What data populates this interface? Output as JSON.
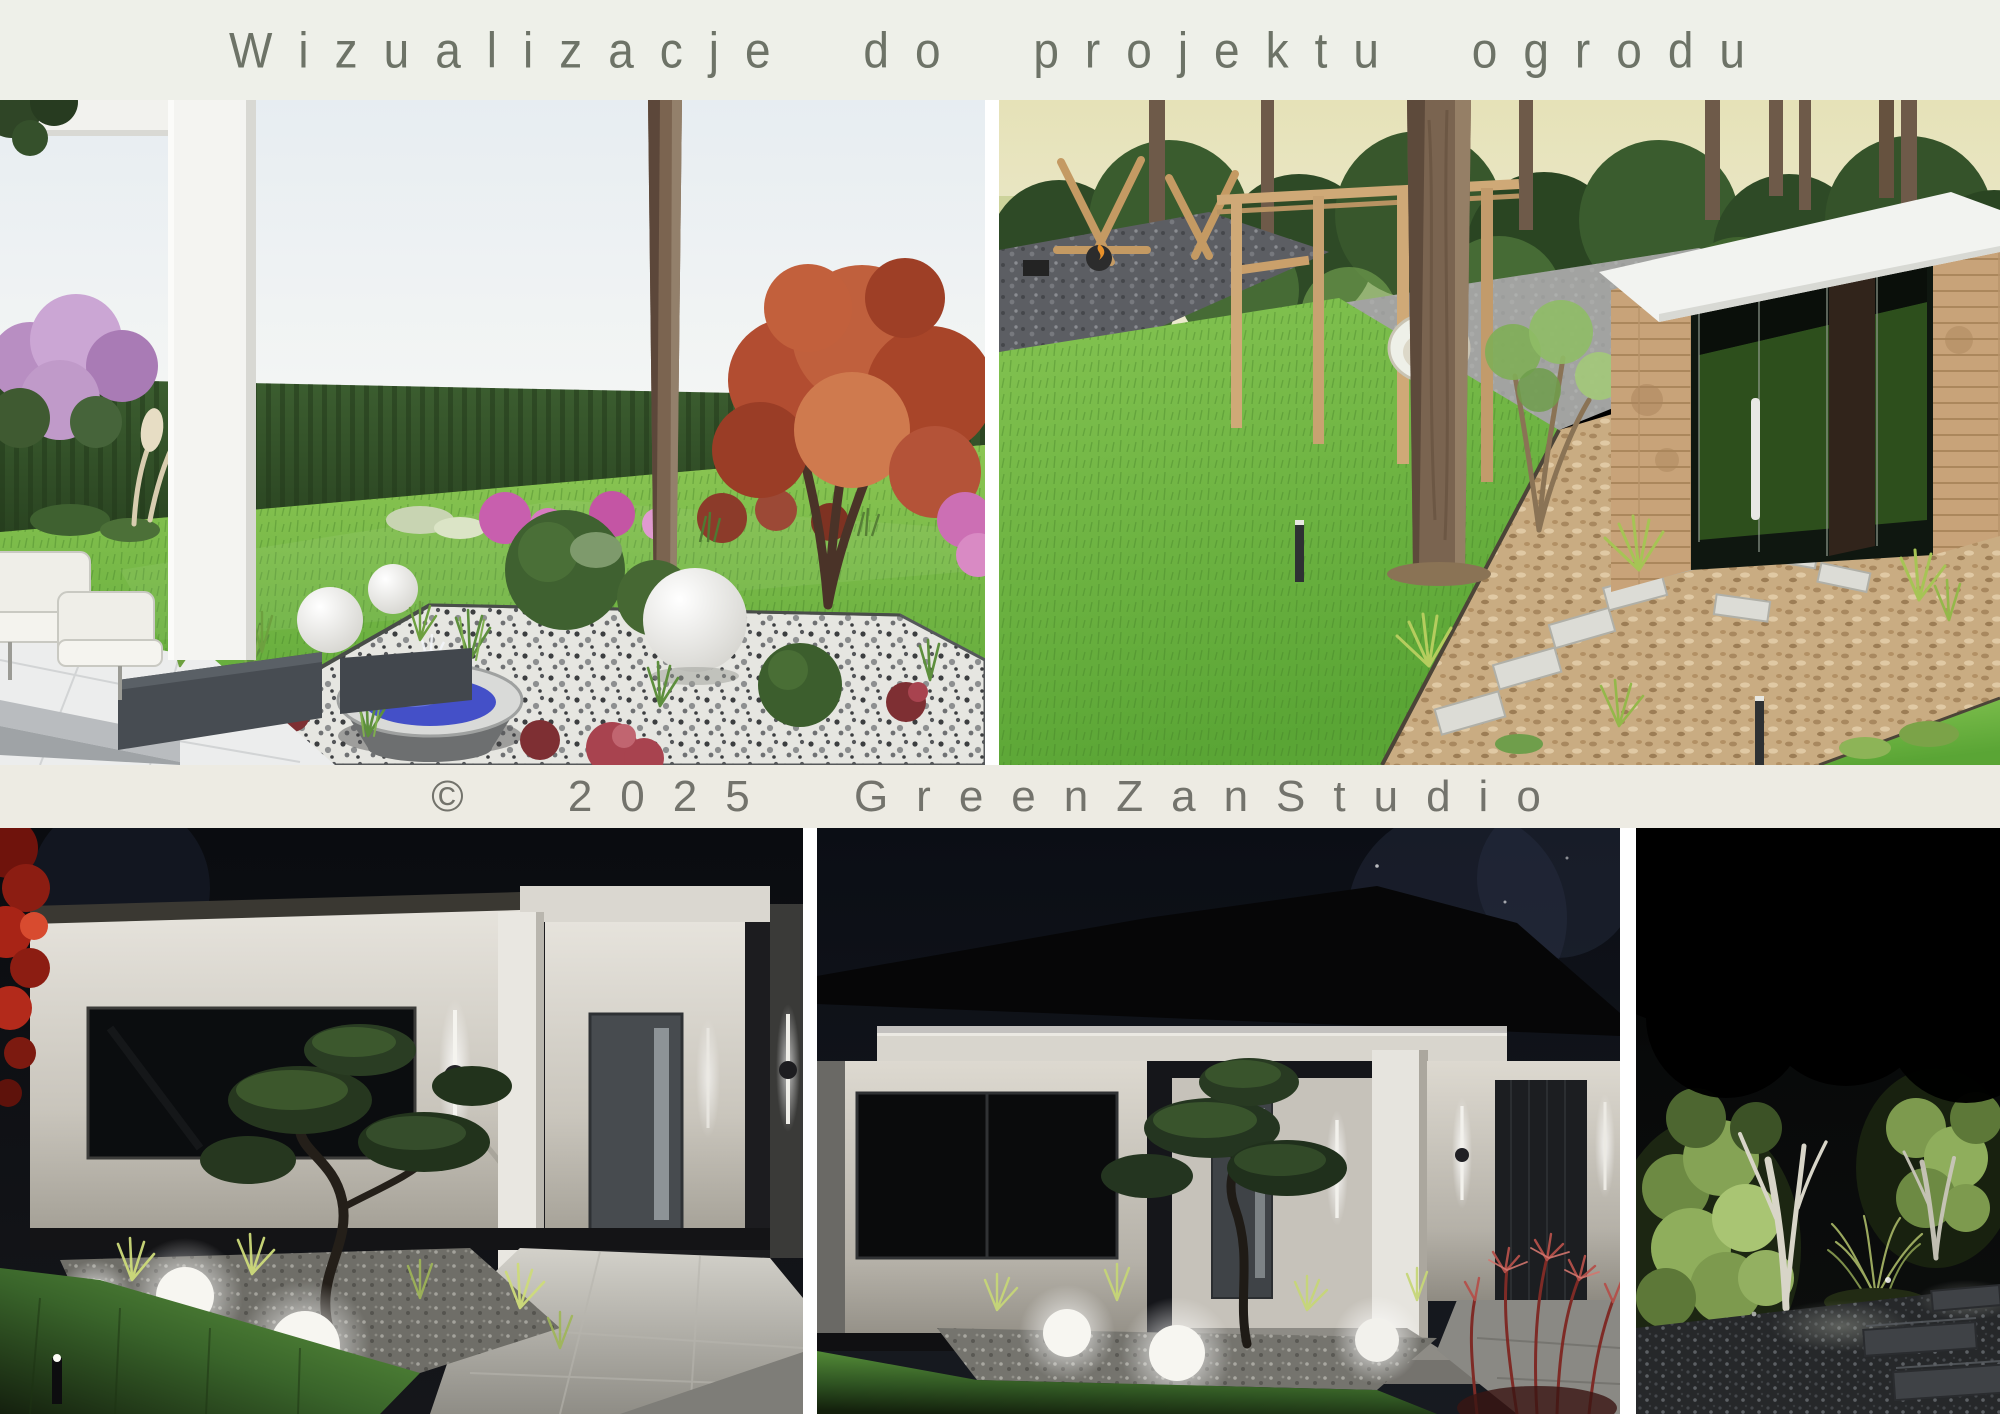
{
  "poster": {
    "width_px": 2000,
    "height_px": 1414,
    "background": "#ffffff",
    "gap_color": "#ffffff"
  },
  "header": {
    "title": "Wizualizacje do projektu ogrodu",
    "background": "#eef0e9",
    "text_color": "#6d7367"
  },
  "copyright_bar": {
    "text": "© 2025 GreenZanStudio",
    "background": "#edebe3",
    "text_color": "#73736c"
  },
  "panels": [
    {
      "id": "top-left",
      "description": "Daytime garden render: white patio columns and terrace, grey planter boxes, white marble pebble island bed with steel bowl fountain with blue water, white sphere lamps, boxwood balls, ornamental grasses, red heuchera, red Japanese maple, pink azaleas and lilac, tall thuja hedge with wire fence and pale field beyond",
      "palette": {
        "sky": "#e9eff3",
        "lawn": "#69b23f",
        "hedge": "#33512a",
        "maple": "#b24d31",
        "fountain_water": "#4450c8"
      }
    },
    {
      "id": "top-right",
      "description": "Daytime garden render: diagonal lawn, bark mulch bed with light stepping stones, tall pine trunk, wooden pergola with hanging egg chair, dark gravel fire-pit corner with timber frame, timber cube garden room with dark glass front, white handle and white roof",
      "palette": {
        "sky": "#e3dfb2",
        "lawn": "#6ab33e",
        "bark": "#c9ac82",
        "cube_wood": "#c8a379"
      }
    },
    {
      "id": "bottom-left",
      "description": "Night render: house entrance with illuminated white facade, dark window, vertical LED wall lights with disc, recessed grey door, cloud-pruned niwaki pine, glowing sphere lamps on gravel, uplit lawn, light tiled walkway, red creeper on left edge",
      "palette": {
        "night": "#0a0c10",
        "wall": "#ddd9d1",
        "grass": "#4f8a36",
        "creeper": "#b32a1b"
      }
    },
    {
      "id": "bottom-middle",
      "description": "Night render: wide view of single-storey house with dark hip roof, lit white walls, dark windows, porch column, vertical LED sconces, dark garage door, niwaki tree with three glowing sphere lamps, lawn and red fountain grasses in foreground",
      "palette": {
        "night": "#0b0e15",
        "wall": "#d5d1c8",
        "grass": "#4f8a36",
        "red_grass": "#b4504a"
      }
    },
    {
      "id": "bottom-right",
      "description": "Night render: garden corner with uplit multi-stem trees with white trunks, illuminated hedge foliage, ornamental grass mound, hostas, gravel with rectangular stepping slabs",
      "palette": {
        "night": "#050607",
        "foliage": "#8fae5c",
        "slab": "#3f4246"
      }
    }
  ]
}
